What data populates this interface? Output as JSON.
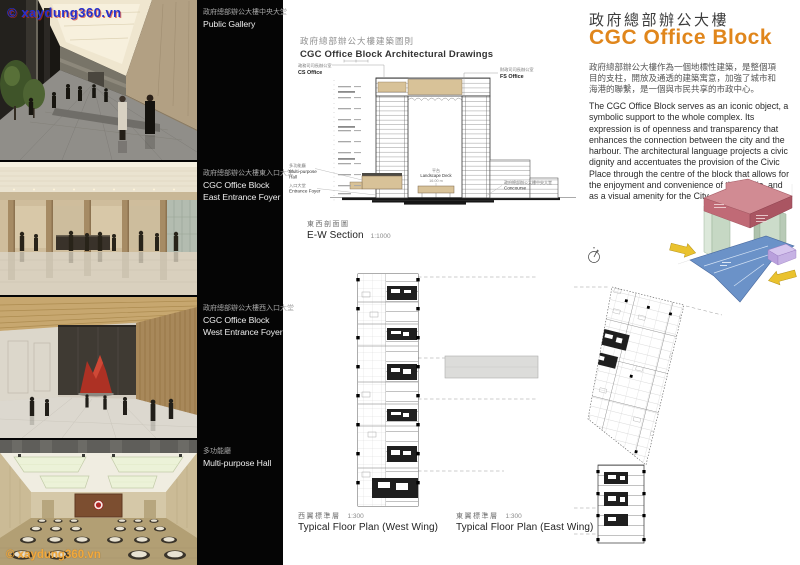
{
  "watermark": {
    "top": "© xaydung360.vn",
    "bottom": "© xaydung360.vn"
  },
  "photos": [
    {
      "zh": "政府總部辦公大樓中央大堂",
      "en1": "Public Gallery",
      "en2": ""
    },
    {
      "zh": "政府總部辦公大樓東入口大堂",
      "en1": "CGC Office Block",
      "en2": "East Entrance Foyer"
    },
    {
      "zh": "政府總部辦公大樓西入口大堂",
      "en1": "CGC Office Block",
      "en2": "West Entrance Foyer"
    },
    {
      "zh": "多功能廳",
      "en1": "Multi-purpose Hall",
      "en2": ""
    }
  ],
  "drawings": {
    "title_zh": "政府總部辦公大樓建築圖則",
    "title_en": "CGC Office Block Architectural Drawings",
    "section": {
      "cs_zh": "政務司司長辦公室",
      "cs_en": "CS Office",
      "fs_zh": "財政司司長辦公室",
      "fs_en": "FS Office",
      "hall_zh": "多功能廳",
      "hall_en1": "Multi-purpose",
      "hall_en2": "Hall",
      "foyer_zh": "入口大堂",
      "foyer_en": "Entrance Foyer",
      "deck_zh": "平台",
      "deck_en": "Landscape Deck",
      "deck_level": "16.00 m",
      "concourse_zh": "政府總部辦公大樓中央大堂",
      "concourse_en": "Concourse",
      "caption_zh": "東西剖面圖",
      "caption_en": "E-W Section",
      "scale": "1:1000"
    },
    "west_plan": {
      "caption_zh": "西翼標準層",
      "scale": "1:300",
      "caption_en": "Typical Floor Plan (West Wing)"
    },
    "east_plan": {
      "caption_zh": "東翼標準層",
      "scale": "1:300",
      "caption_en": "Typical Floor Plan (East Wing)"
    }
  },
  "overview": {
    "title_zh": "政府總部辦公大樓",
    "title_en": "CGC Office Block",
    "body_zh": "政府總部辦公大樓作為一個地標性建築，是整個項目的支柱，開放及通透的建築寓意，加強了城市和海港的聯繫，是一個與市民共享的市政中心。",
    "body_en": "The CGC Office Block serves as an iconic object, a symbolic support to the whole complex. Its expression is of openness and transparency that enhances the connection between the city and the harbour.  The architectural language projects a civic dignity and accentuates the provision of the Civic Place through the centre of the block that allows for the enjoyment and convenience of the public, and as a visual amenity for the City."
  },
  "colors": {
    "accent_orange": "#E0861C",
    "watermark_blue": "#2430CD",
    "watermark_orange": "#F2A93C",
    "diagram_red_top": "#D18B93",
    "diagram_red_front": "#C06A76",
    "diagram_red_side": "#AA5562",
    "diagram_green": "#C6D8C4",
    "diagram_green_light": "#DCE8DA",
    "diagram_blue": "#6B92C8",
    "diagram_purple": "#D6C6EE",
    "diagram_yellow": "#EAC22E",
    "drawing_tan": "#D8C298"
  }
}
